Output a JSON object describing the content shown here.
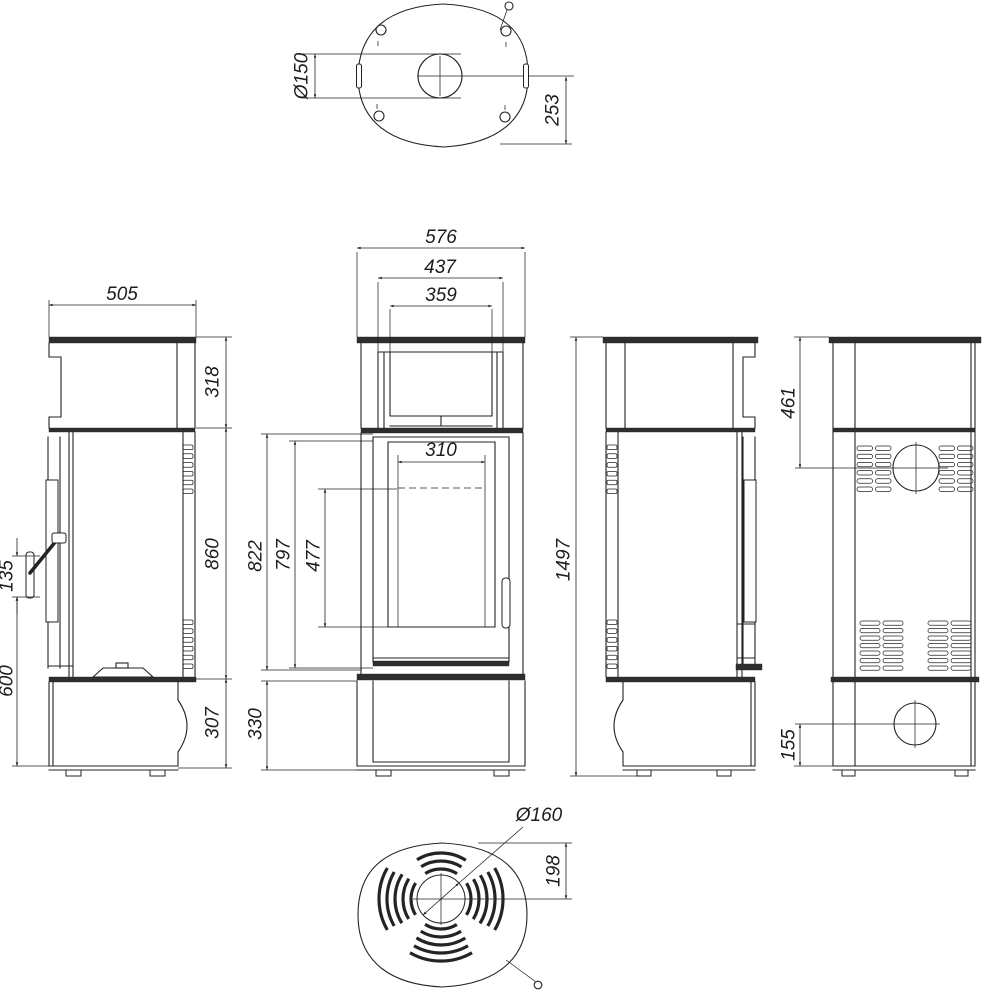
{
  "drawing": {
    "background": "#ffffff",
    "line_color": "#232323"
  },
  "dims": {
    "top": {
      "flue_diameter": "Ø150",
      "flue_center_to_back": "253"
    },
    "left": {
      "depth": "505",
      "top_section_height": "318",
      "body_height": "860",
      "base_height": "307",
      "handle_length": "135",
      "handle_to_floor": "600"
    },
    "front": {
      "total_width": "576",
      "upper_frame_width": "437",
      "upper_opening_width": "359",
      "glass_width": "310",
      "door_outer_height": "822",
      "door_height": "797",
      "glass_height": "477",
      "base_height": "330"
    },
    "right": {
      "total_height": "1497"
    },
    "back": {
      "flue_center_from_top": "461",
      "inlet_center_from_floor": "155"
    },
    "bottom": {
      "inlet_diameter": "Ø160",
      "inlet_center_to_back": "198"
    }
  }
}
